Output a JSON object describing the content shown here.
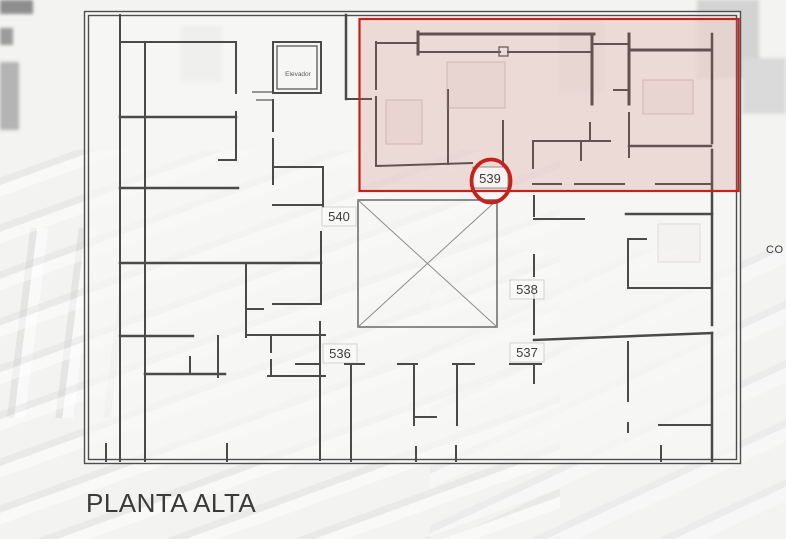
{
  "plan": {
    "title": "PLANTA ALTA",
    "elevator_label": "Elevador",
    "units": {
      "u536": "536",
      "u537": "537",
      "u538": "538",
      "u539": "539",
      "u540": "540"
    },
    "highlighted_unit": "539",
    "right_edge_text": "CO"
  },
  "colors": {
    "highlight_red": "#c5221c",
    "highlight_fill": "rgba(200,118,108,0.22)",
    "wall": "#4a4a4a",
    "label_text": "#3d3d3d",
    "title_text": "#3a3a3a",
    "plan_sheet": "rgba(247,246,245,0.72)"
  }
}
